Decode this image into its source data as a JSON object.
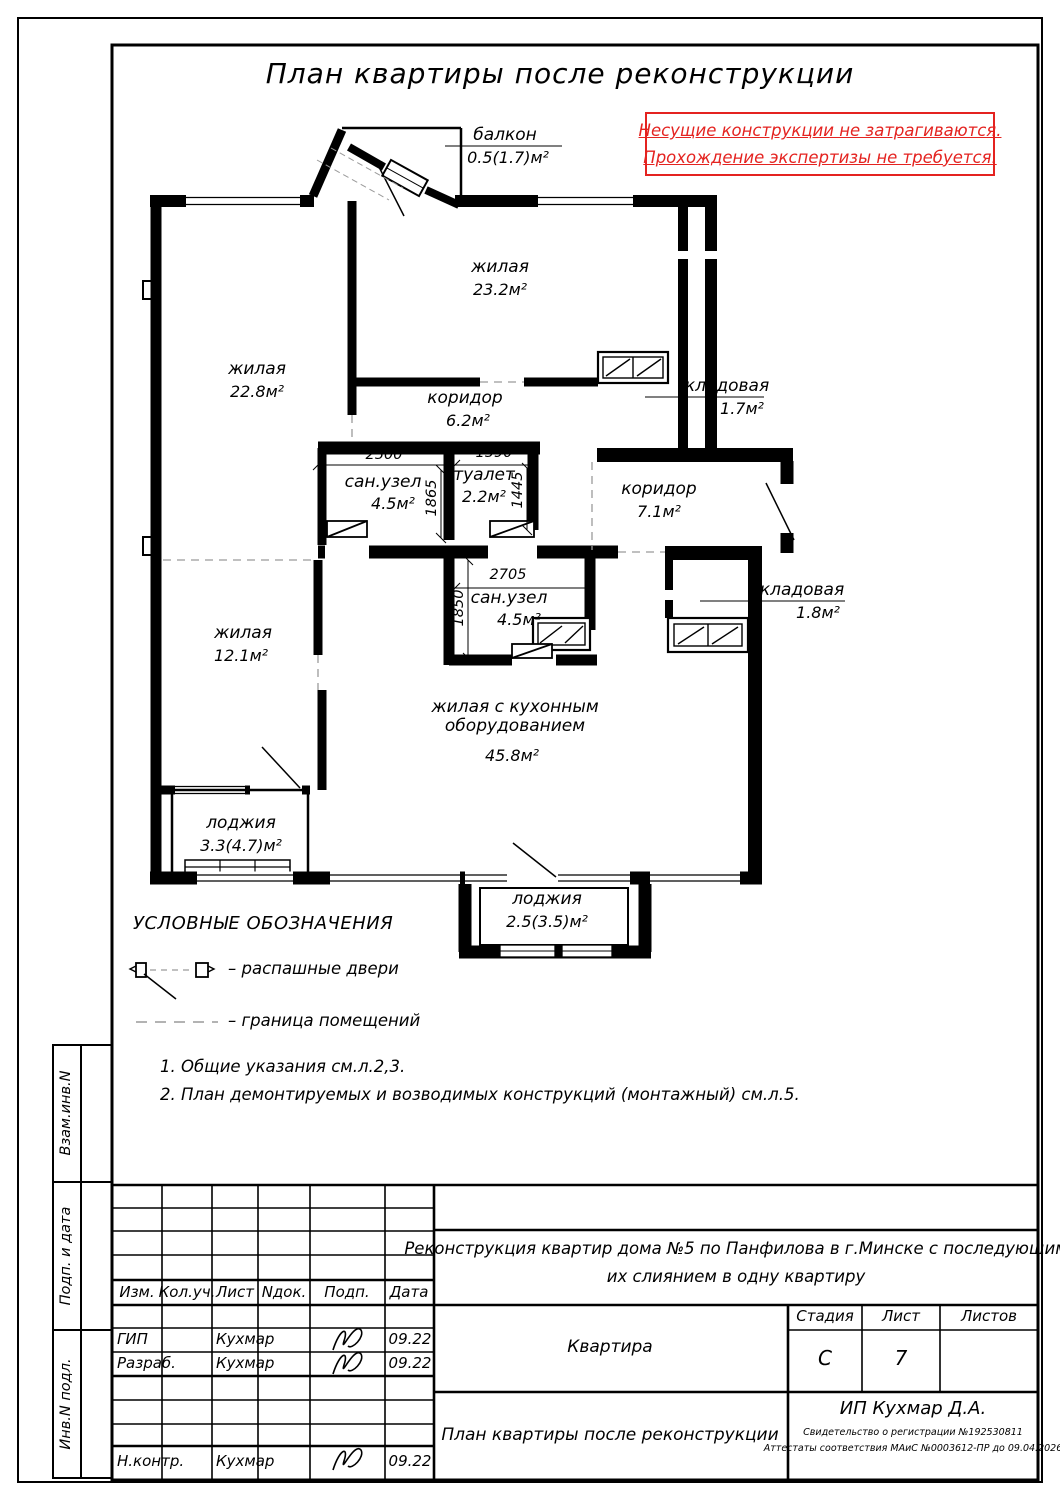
{
  "sheet": {
    "title": "План квартиры после реконструкции",
    "warning": {
      "line1": "Несущие конструкции не затрагиваются.",
      "line2": "Прохождение экспертизы не требуется.",
      "color": "#e42320"
    },
    "side_labels": [
      "Взам.инв.N",
      "Подп. и дата",
      "Инв.N подл."
    ]
  },
  "plan": {
    "rooms": [
      {
        "name": "балкон",
        "area": "0.5(1.7)м²"
      },
      {
        "name": "жилая",
        "area": "23.2м²"
      },
      {
        "name": "жилая",
        "area": "22.8м²"
      },
      {
        "name": "коридор",
        "area": "6.2м²"
      },
      {
        "name": "кладовая",
        "area": "1.7м²"
      },
      {
        "name": "сан.узел",
        "area": "4.5м²"
      },
      {
        "name": "туалет",
        "area": "2.2м²"
      },
      {
        "name": "коридор",
        "area": "7.1м²"
      },
      {
        "name": "кладовая",
        "area": "1.8м²"
      },
      {
        "name": "сан.узел",
        "area": "4.5м²"
      },
      {
        "name": "жилая",
        "area": "12.1м²"
      },
      {
        "name": "жилая с кухонным оборудованием",
        "area": "45.8м²"
      },
      {
        "name": "лоджия",
        "area": "3.3(4.7)м²"
      },
      {
        "name": "лоджия",
        "area": "2.5(3.5)м²"
      }
    ],
    "dims": [
      "2500",
      "1590",
      "1865",
      "1445",
      "2705",
      "1850"
    ]
  },
  "legend": {
    "title": "УСЛОВНЫЕ ОБОЗНАЧЕНИЯ",
    "items": [
      {
        "label": "–  распашные двери"
      },
      {
        "label": "–  граница помещений"
      }
    ]
  },
  "notes": [
    "1. Общие указания см.л.2,3.",
    "2. План демонтируемых и возводимых конструкций (монтажный) см.л.5."
  ],
  "titleblock": {
    "columns": [
      "Изм.",
      "Кол.уч.",
      "Лист",
      "Nдок.",
      "Подп.",
      "Дата"
    ],
    "staff": [
      {
        "role": "ГИП",
        "name": "Кухмар",
        "date": "09.22"
      },
      {
        "role": "Разраб.",
        "name": "Кухмар",
        "date": "09.22"
      },
      {
        "role": "Н.контр.",
        "name": "Кухмар",
        "date": "09.22"
      }
    ],
    "project_line1": "Реконструкция квартир дома №5 по Панфилова в г.Минске с последующим",
    "project_line2": "их слиянием в одну квартиру",
    "object_name": "Квартира",
    "stage_label": "Стадия",
    "sheet_label": "Лист",
    "sheets_label": "Листов",
    "stage": "С",
    "sheet_no": "7",
    "sheets_total": "",
    "doc_title": "План квартиры после реконструкции",
    "firm_name": "ИП Кухмар Д.А.",
    "firm_cert1": "Свидетельство о регистрации №192530811",
    "firm_cert2": "Аттестаты соответствия МАиС №0003612-ПР до 09.04.2026"
  }
}
